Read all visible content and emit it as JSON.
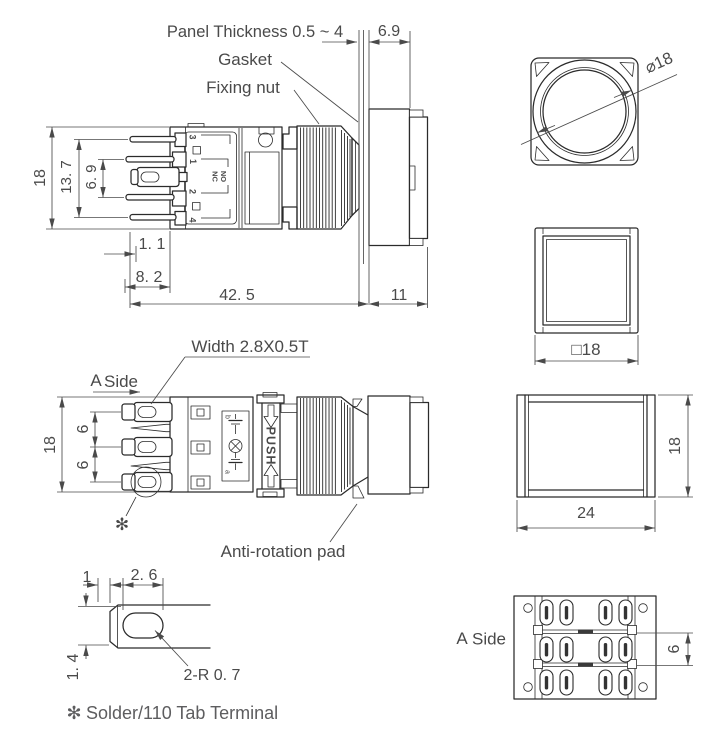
{
  "colors": {
    "line": "#2b2b2b",
    "text": "#4a4a4a",
    "note_text": "#5d5d5f",
    "background": "#ffffff"
  },
  "side_view_top": {
    "callout_panel_thickness": "Panel Thickness 0.5 ~ 4",
    "callout_gasket": "Gasket",
    "callout_fixing_nut": "Fixing nut",
    "dim_height": "18",
    "dim_pin_span": "13. 7",
    "dim_pin_pitch": "6. 9",
    "dim_protrusion": "6.9",
    "dim_pin_offset": "1. 1",
    "dim_pin_inset": "8. 2",
    "dim_body_length": "42. 5",
    "dim_head_length": "11",
    "mark_pin3": "3",
    "mark_pin1": "1",
    "mark_pin2": "2",
    "mark_pin4": "4",
    "mark_no": "NO",
    "mark_nc": "NC"
  },
  "front_view_round": {
    "dim_diameter": "⌀18"
  },
  "front_view_square": {
    "dim_size": "□18"
  },
  "side_view_a": {
    "callout_terminal_width": "Width 2.8X0.5T",
    "label_a": "A",
    "label_side": "Side",
    "callout_anti_rotation": "Anti-rotation pad",
    "footnote_mark": "✻",
    "dim_height": "18",
    "dim_pitch_upper": "6",
    "dim_pitch_lower": "6",
    "mark_push": "PUSH",
    "mark_contact_b": "b",
    "mark_contact_a": "a"
  },
  "side_view_back": {
    "dim_width": "24",
    "dim_height": "18"
  },
  "terminal_detail": {
    "dim_offset": "1",
    "dim_hole_width": "2. 6",
    "dim_hole_height": "1. 4",
    "callout_radius": "2-R 0. 7"
  },
  "rear_view": {
    "label_a": "A",
    "label_side": "Side",
    "dim_pitch": "6"
  },
  "footnote": {
    "mark": "✻",
    "text": "Solder/110 Tab Terminal"
  }
}
